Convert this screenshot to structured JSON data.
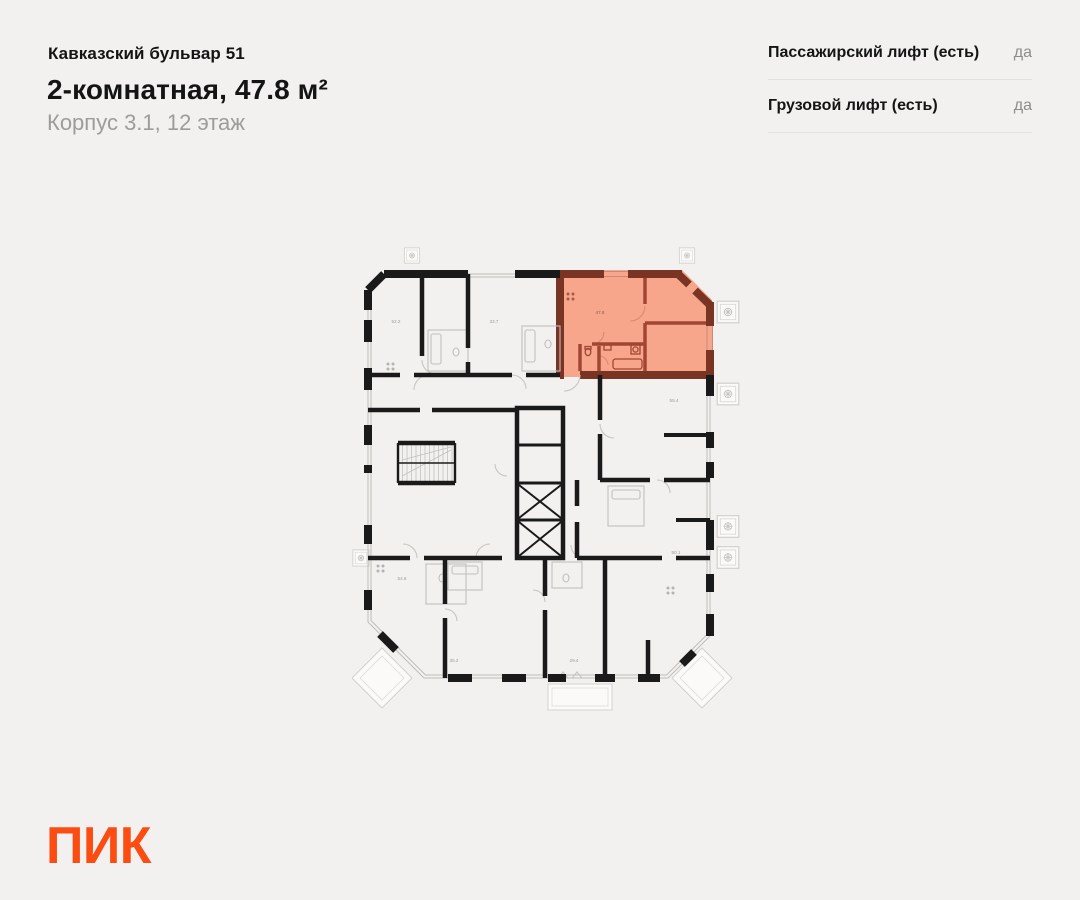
{
  "page": {
    "background": "#F2F1EF"
  },
  "header": {
    "project": "Кавказский бульвар 51",
    "title": "2-комнатная, 47.8 м²",
    "subtitle": "Корпус 3.1, 12 этаж"
  },
  "lift_info": {
    "rows": [
      {
        "label": "Пассажирский лифт (есть)",
        "value": "да"
      },
      {
        "label": "Грузовой лифт (есть)",
        "value": "да"
      }
    ]
  },
  "floorplan": {
    "highlighted": {
      "area": "47.8",
      "fill": "#F7A68B",
      "wall_color": "#7A3423"
    },
    "units": [
      {
        "area": "52.2"
      },
      {
        "area": "33.7"
      },
      {
        "area": "55.4"
      },
      {
        "area": "54.6"
      },
      {
        "area": "50.1"
      },
      {
        "area": "35.2"
      },
      {
        "area": "29.4"
      }
    ],
    "icons": {
      "balcony": "balcony-icon",
      "elevator": "elevator-shaft-icon",
      "stairs": "stairs-icon"
    }
  },
  "logo": {
    "text": "ПИК",
    "color": "#FB4D11"
  }
}
